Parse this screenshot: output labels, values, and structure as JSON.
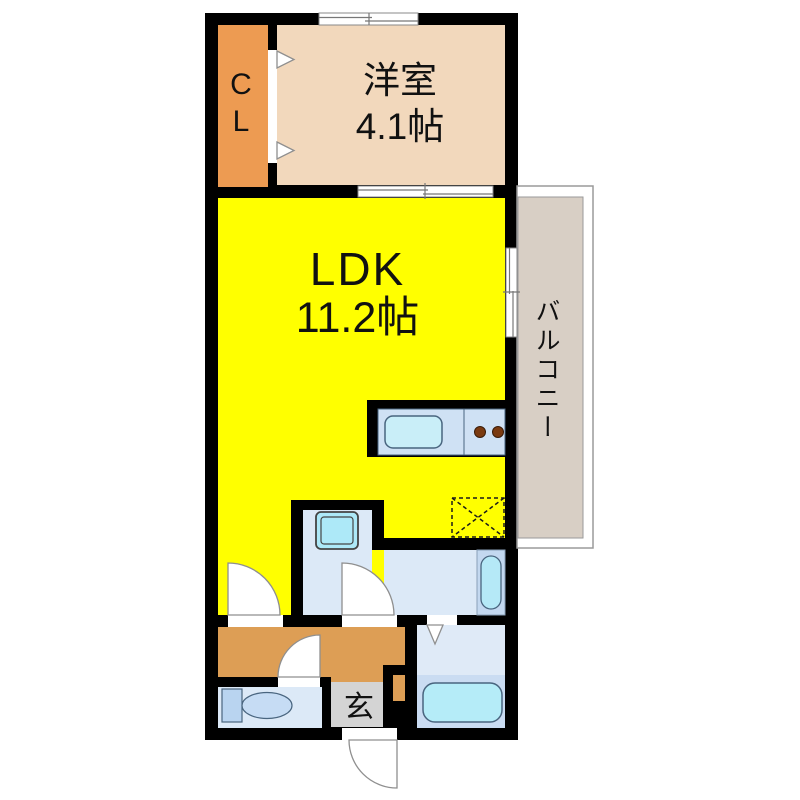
{
  "type": "apartment-floor-plan",
  "labels": {
    "closet": "CL",
    "western_room_name": "洋室",
    "western_room_size": "4.1帖",
    "ldk_name": "LDK",
    "ldk_size": "11.2帖",
    "balcony": "バルコニー",
    "entrance": "玄"
  },
  "rooms": [
    {
      "name": "closet",
      "label": "CL"
    },
    {
      "name": "western-room",
      "label": "洋室 4.1帖"
    },
    {
      "name": "ldk",
      "label": "LDK 11.2帖"
    },
    {
      "name": "balcony",
      "label": "バルコニー"
    },
    {
      "name": "entrance",
      "label": "玄"
    },
    {
      "name": "hallway",
      "label": ""
    },
    {
      "name": "washroom",
      "label": ""
    },
    {
      "name": "bathroom",
      "label": ""
    },
    {
      "name": "toilet-room",
      "label": ""
    }
  ],
  "fixtures": [
    "kitchen-sink",
    "stove-burners",
    "refrigerator-space",
    "washing-machine-space",
    "washbasin",
    "bathtub",
    "toilet",
    "entrance-door",
    "closet-folding-door",
    "sliding-door",
    "window"
  ],
  "colors": {
    "wall": "#000000",
    "ldk": "#ffff00",
    "western_room": "#f2d8bc",
    "closet": "#ed9b52",
    "hallway": "#dd9e55",
    "balcony": "#d8cfc5",
    "wet_room": "#dce9f7",
    "bath_lower": "#cadcf2",
    "vanity_strip": "#c3d8f0",
    "fixture_cyan": "#b5ecf8",
    "entrance_floor": "#d4d4d4",
    "burner_brown": "#7a3a10",
    "door_stroke": "#8f8f8f"
  }
}
